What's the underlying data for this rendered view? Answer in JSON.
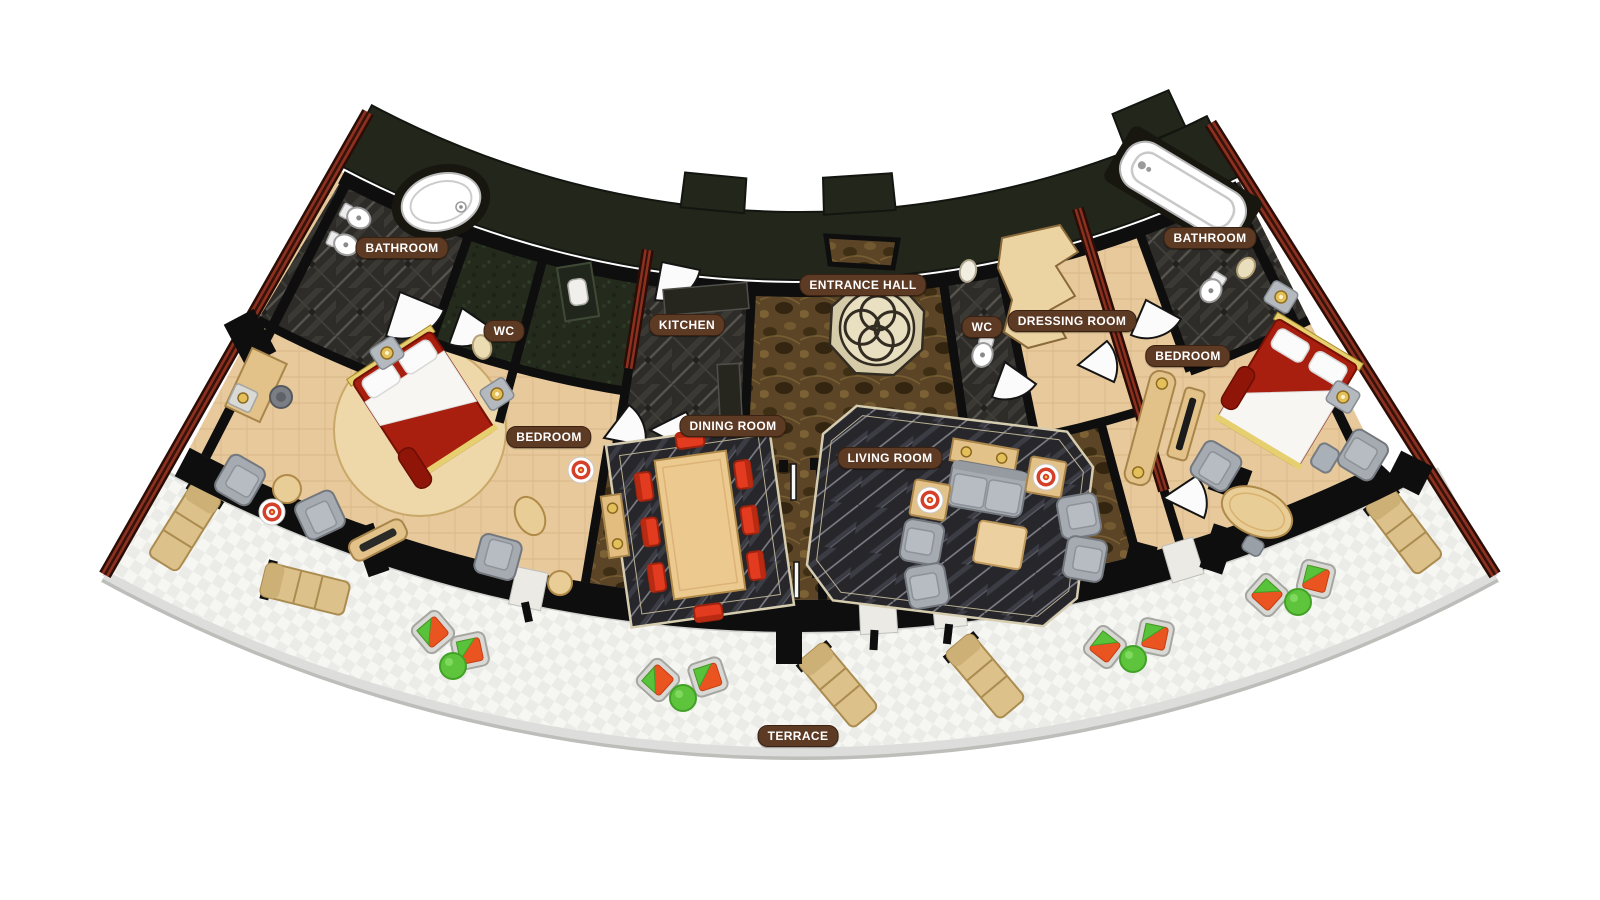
{
  "plan": {
    "type": "floor-plan",
    "rooms": [
      {
        "id": "bathroom-left",
        "label": "BATHROOM"
      },
      {
        "id": "wc-left",
        "label": "WC"
      },
      {
        "id": "kitchen",
        "label": "KITCHEN"
      },
      {
        "id": "entrance-hall",
        "label": "ENTRANCE HALL"
      },
      {
        "id": "wc-right",
        "label": "WC"
      },
      {
        "id": "dressing-room",
        "label": "DRESSING ROOM"
      },
      {
        "id": "bathroom-right",
        "label": "BATHROOM"
      },
      {
        "id": "bedroom-left",
        "label": "BEDROOM"
      },
      {
        "id": "dining-room",
        "label": "DINING ROOM"
      },
      {
        "id": "living-room",
        "label": "LIVING ROOM"
      },
      {
        "id": "bedroom-right",
        "label": "BEDROOM"
      },
      {
        "id": "terrace",
        "label": "TERRACE"
      }
    ],
    "colors": {
      "label_bg": "#5d3a24",
      "label_text": "#ffffff",
      "floor_beige": "#e7c99b",
      "marble_charcoal": "#2e2c29",
      "marble_brown": "#5c4526",
      "marble_black": "#26262b",
      "shaft_green": "#242b1d",
      "wall_black": "#0e0e0e",
      "wall_red": "#8c3020",
      "bed_red": "#a81e0f",
      "dining_chair_red": "#e23b20",
      "sofa_gray": "#a6abb2",
      "wood_tan": "#dcc18a",
      "terrace_white": "#f6f6f3",
      "cushion_orange": "#ea5420",
      "pillow_green": "#58c23a",
      "gold": "#e4c05a"
    }
  }
}
